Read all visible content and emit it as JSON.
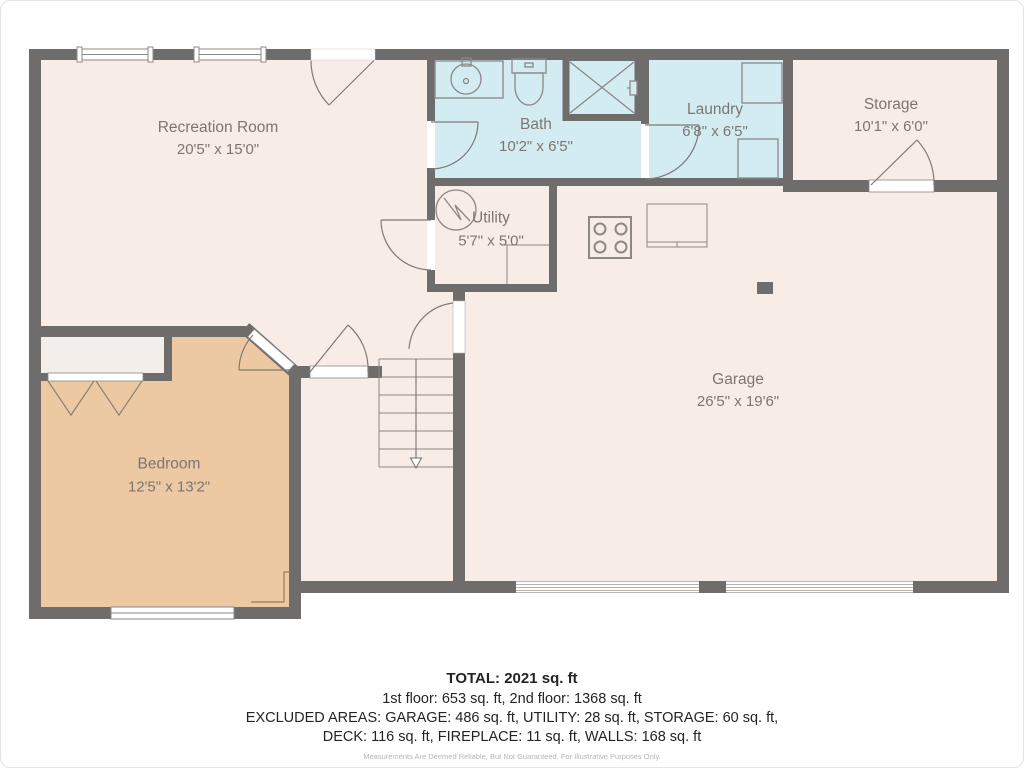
{
  "rooms": {
    "recreation": {
      "name": "Recreation Room",
      "dims": "20'5\" x 15'0\""
    },
    "bath": {
      "name": "Bath",
      "dims": "10'2\" x 6'5\""
    },
    "laundry": {
      "name": "Laundry",
      "dims": "6'8\" x 6'5\""
    },
    "storage": {
      "name": "Storage",
      "dims": "10'1\" x 6'0\""
    },
    "utility": {
      "name": "Utility",
      "dims": "5'7\" x 5'0\""
    },
    "garage": {
      "name": "Garage",
      "dims": "26'5\" x 19'6\""
    },
    "bedroom": {
      "name": "Bedroom",
      "dims": "12'5\" x 13'2\""
    }
  },
  "summary": {
    "total": "TOTAL: 2021 sq. ft",
    "floors": "1st floor: 653 sq. ft, 2nd floor: 1368 sq. ft",
    "excluded1": "EXCLUDED AREAS: GARAGE: 486 sq. ft, UTILITY: 28 sq. ft, STORAGE: 60 sq. ft,",
    "excluded2": "DECK: 116 sq. ft, FIREPLACE: 11 sq. ft, WALLS: 168 sq. ft",
    "disclaimer": "Measurements Are Deemed Reliable, But Not Guaranteed. For Illustrative Purposes Only."
  },
  "colors": {
    "wall": "#6f6c6c",
    "floor": "#f7ece6",
    "bedroom_floor": "#ecc8a3",
    "wet_floor": "#d3ecf2",
    "closet_floor": "#f4eeea",
    "fixture_line": "#8b8886",
    "label_text": "#7c7672",
    "disclaimer_text": "#b9b5b2"
  },
  "fixtures": [
    "sink",
    "toilet",
    "shower",
    "washer",
    "dryer",
    "water-heater",
    "stove",
    "counter",
    "support-post",
    "stairs-down-arrow",
    "fireplace",
    "bifold-doors"
  ]
}
